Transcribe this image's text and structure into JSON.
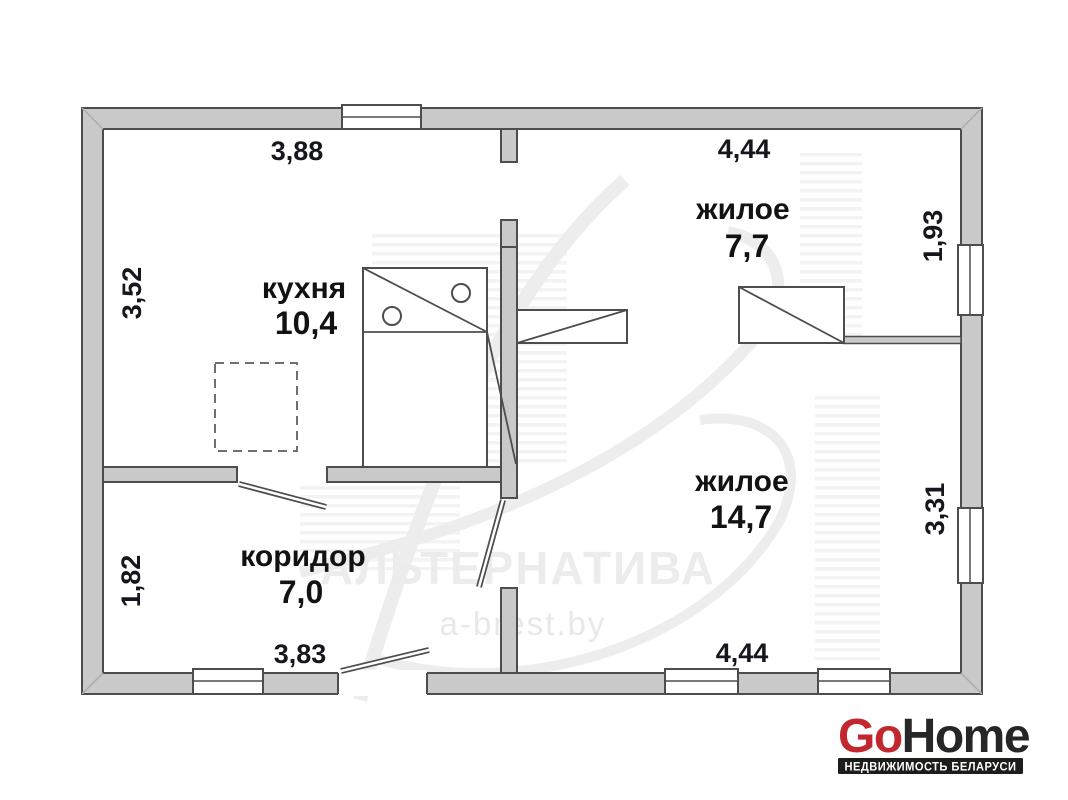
{
  "plan": {
    "rooms": [
      {
        "name": "кухня",
        "area": "10,4"
      },
      {
        "name": "жилое",
        "area": "7,7"
      },
      {
        "name": "жилое",
        "area": "14,7"
      },
      {
        "name": "коридор",
        "area": "7,0"
      }
    ],
    "dimensions": {
      "kitchen_width_top": "3,88",
      "kitchen_height_left": "3,52",
      "room77_width_top": "4,44",
      "room77_height_right": "1,93",
      "room147_height_right": "3,31",
      "room147_width_bottom": "4,44",
      "corridor_height_left": "1,82",
      "corridor_width_bottom": "3,83"
    },
    "colors": {
      "wall_fill": "#c9c9c9",
      "wall_outline": "#4d4d4d",
      "label_color": "#16161f"
    }
  },
  "watermark": {
    "agency": "АЛЬТЕРНАТИВА",
    "site": "a-brest.by"
  },
  "logo": {
    "go": "Go",
    "home": "Home",
    "tagline": "НЕДВИЖИМОСТЬ БЕЛАРУСИ",
    "go_color": "#c1272d",
    "home_color": "#262626",
    "bar_color": "#1d1d1b"
  }
}
